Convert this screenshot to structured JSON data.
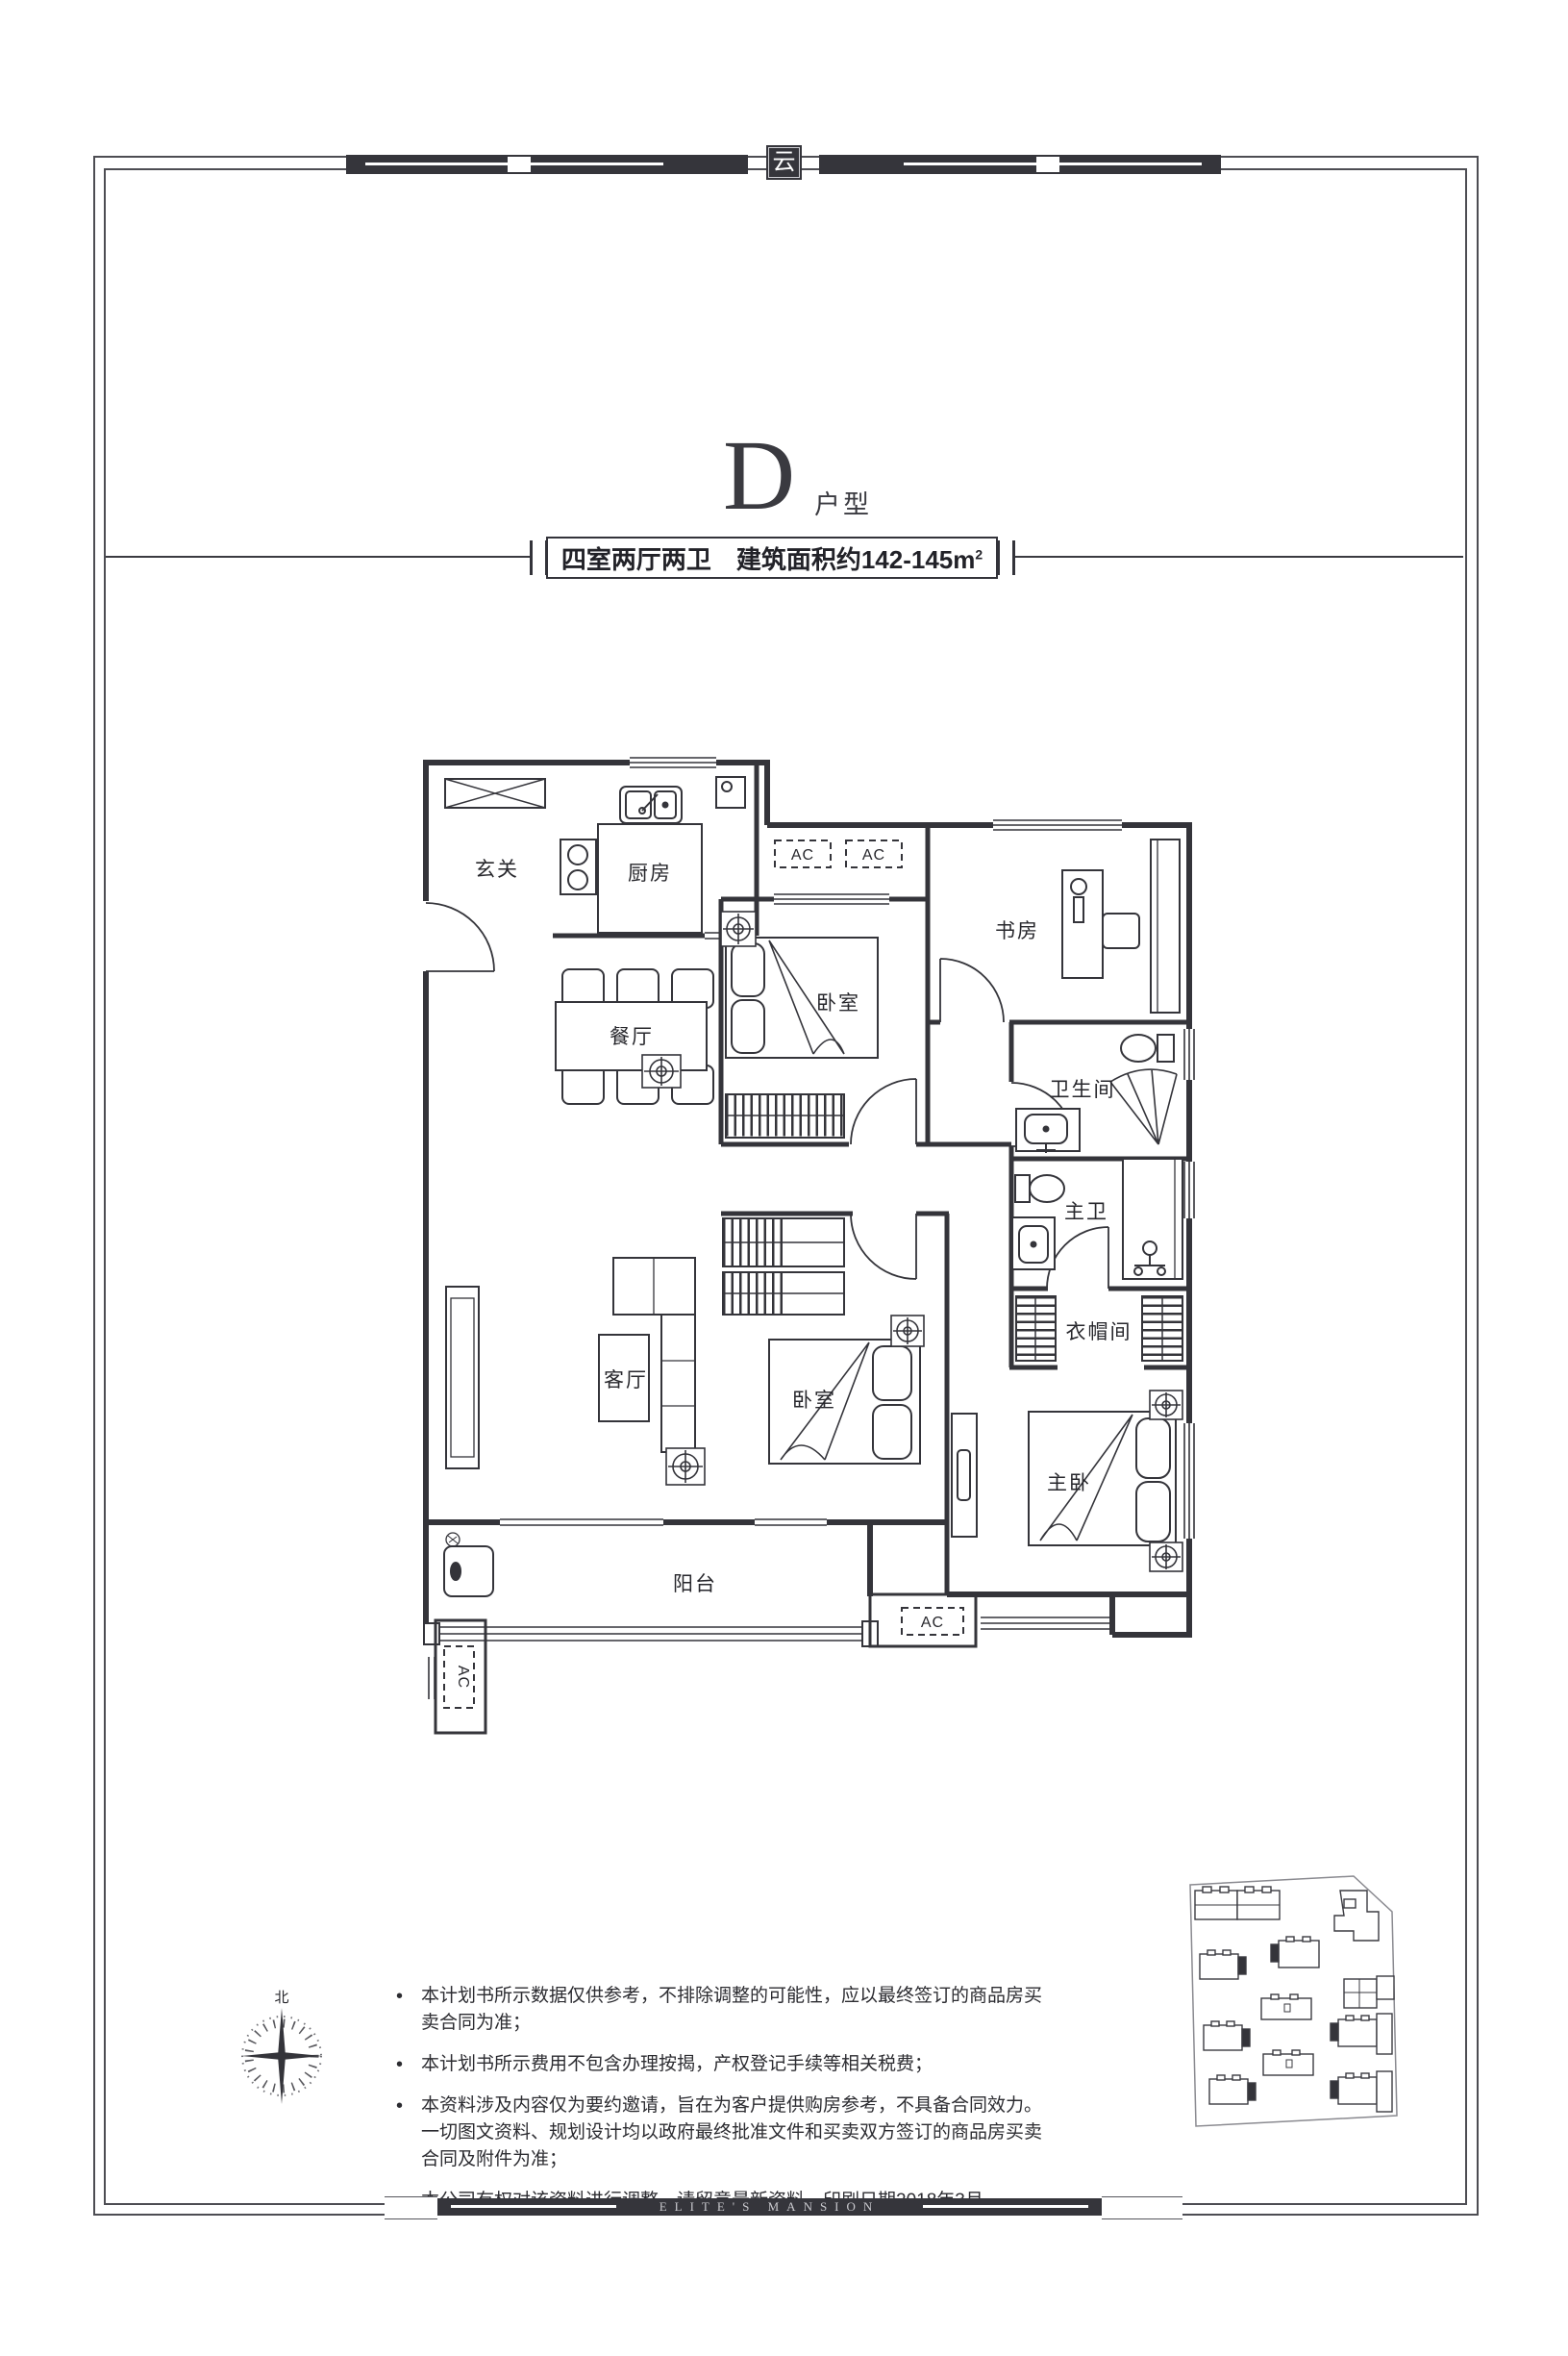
{
  "header": {
    "plan_letter": "D",
    "plan_suffix": "户型",
    "banner_main": "四室两厅两卫",
    "banner_area": "建筑面积约142-145m",
    "banner_sup": "2"
  },
  "plan": {
    "rooms": {
      "entry": "玄关",
      "kitchen": "厨房",
      "dining": "餐厅",
      "bedroom_top": "卧室",
      "study": "书房",
      "bathroom": "卫生间",
      "master_bath": "主卫",
      "closet": "衣帽间",
      "living": "客厅",
      "bedroom_mid": "卧室",
      "master": "主卧",
      "balcony": "阳台"
    },
    "ac_label": "AC",
    "compass_north": "北"
  },
  "notes": {
    "bullet": "•",
    "items": [
      "本计划书所示数据仅供参考，不排除调整的可能性，应以最终签订的商品房买卖合同为准；",
      "本计划书所示费用不包含办理按揭，产权登记手续等相关税费；",
      "本资料涉及内容仅为要约邀请，旨在为客户提供购房参考，不具备合同效力。一切图文资料、规划设计均以政府最终批准文件和买卖双方签订的商品房买卖合同及附件为准；",
      "本公司有权对该资料进行调整，请留意最新资料。印刷日期2018年3月。"
    ]
  },
  "decor": {
    "seal": "云"
  },
  "footer": {
    "brand": "ELITE'S MANSION"
  }
}
